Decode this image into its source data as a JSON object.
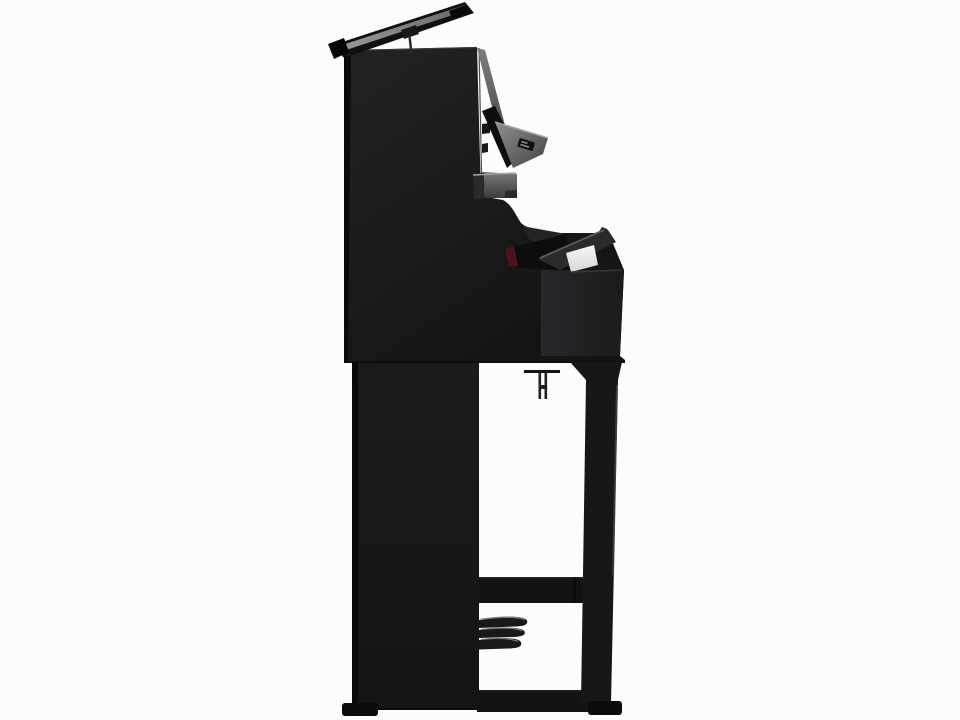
{
  "scene": {
    "title": "Black upright digital piano — side profile product photo",
    "subject": "upright digital piano, polished ebony, side view, music rest raised, keyboard lid open, three pedals"
  },
  "colors": {
    "background": "#fcfcfc",
    "body_light": "#232323",
    "body": "#1b1b1b",
    "body_dark": "#141414",
    "edge_black": "#070707",
    "left_edge": "#0a0a0a",
    "top_highlight": "#3a3a3a",
    "rest_gray_light": "#9a9a9a",
    "rest_gray_dark": "#686868",
    "rest_black": "#101010",
    "lid_strip_light": "#7e7e7e",
    "lid_strip_dark": "#383838",
    "lid_face_light": "#909090",
    "lid_face_dark": "#424242",
    "lid_black": "#0d0d0d",
    "box_gray_light": "#7a7a7a",
    "box_gray_dark": "#3c3c3c",
    "box_side": "#2a2a2a",
    "box_highlight": "#a2a2a2",
    "hinge": "#181818",
    "keys_black": "#0d0d0d",
    "felt_red": "#4a161a",
    "fallboard": "#2b2b2e",
    "fallboard_edge": "#5a5a5a",
    "white_key_light": "#f5f5f5",
    "white_key_dark": "#d8d8d8",
    "keybed_light": "#28282c",
    "keybed_dark": "#1b1b1d",
    "interior": "#242427",
    "leg": "#17171a",
    "leg_highlight": "#47474b",
    "stretcher": "#121214",
    "rail": "#131315",
    "pedal": "#19191b",
    "pedal_highlight": "#787878",
    "bracket": "#202020",
    "plate": "#0f0f0f",
    "plate_dash": "#8c8c8c",
    "foot": "#0c0c0c",
    "slip_line": "#3c3c3c"
  }
}
